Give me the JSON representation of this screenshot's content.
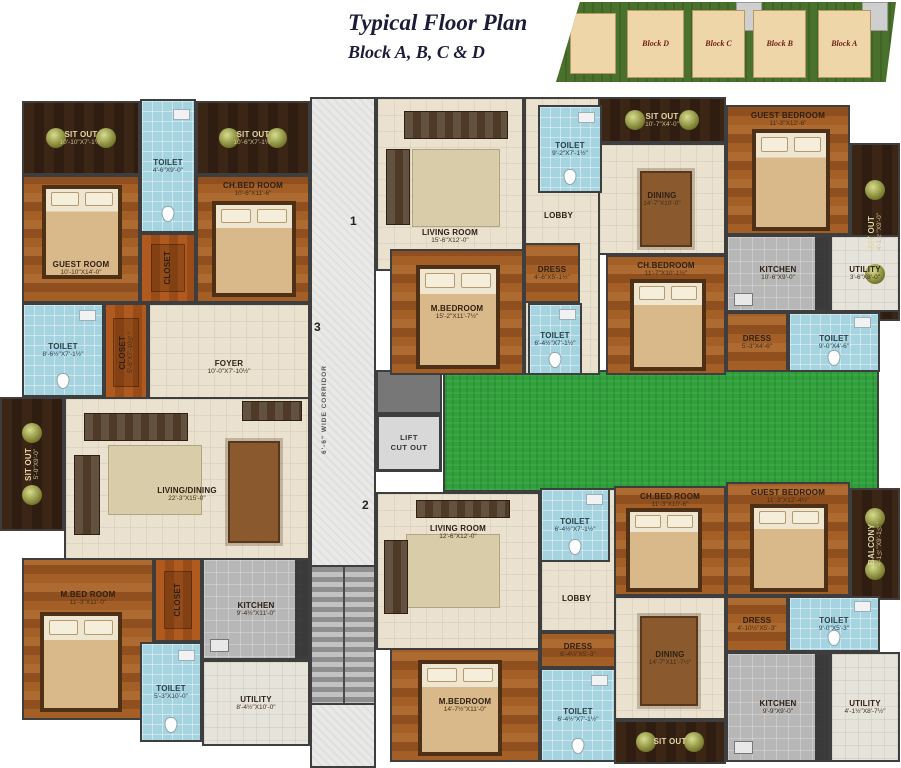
{
  "header": {
    "title": "Typical Floor Plan",
    "subtitle": "Block A, B, C & D"
  },
  "site_plan": {
    "block_d": "Block D",
    "block_c": "Block C",
    "block_b": "Block B",
    "block_a": "Block A"
  },
  "corridor": {
    "width_label": "6'-6\" WIDE CORRIDOR",
    "lift_line1": "LIFT",
    "lift_line2": "CUT OUT",
    "flat1": "1",
    "flat2": "2",
    "flat3": "3"
  },
  "rooms": {
    "sitout_tl": {
      "name": "SIT OUT",
      "dims": "10'-10\"X7'-1½\""
    },
    "toilet_tl": {
      "name": "TOILET",
      "dims": "4'-6\"X9'-0\""
    },
    "sitout_tc": {
      "name": "SIT OUT",
      "dims": "10'-6\"X7'-1½\""
    },
    "guest_room": {
      "name": "GUEST ROOM",
      "dims": "10'-10\"X14'-0\""
    },
    "closet_mid": {
      "name": "CLOSET",
      "dims": "4'-6\"X5'-0\""
    },
    "ch_bedroom_l": {
      "name": "CH.BED ROOM",
      "dims": "10'-6\"X11'-6\""
    },
    "toilet_l2": {
      "name": "TOILET",
      "dims": "8'-6½\"X7'-1½\""
    },
    "closet_l2": {
      "name": "CLOSET",
      "dims": "5'-6\"X7'-10½\""
    },
    "foyer": {
      "name": "FOYER",
      "dims": "10'-0\"X7'-10½\""
    },
    "sitout_lm": {
      "name": "SIT OUT",
      "dims": "5'-0\"X9'-0\""
    },
    "living_dining": {
      "name": "LIVING/DINING",
      "dims": "22'-3\"X15'-0\""
    },
    "mbedroom_l": {
      "name": "M.BED ROOM",
      "dims": "11'-3\"X11'-0\""
    },
    "closet_l3": {
      "name": "CLOSET",
      "dims": "4'-6\"X7'-0\""
    },
    "kitchen_l": {
      "name": "KITCHEN",
      "dims": "9'-4½\"X11'-0\""
    },
    "toilet_l3": {
      "name": "TOILET",
      "dims": "5'-3\"X10'-0\""
    },
    "utility_l": {
      "name": "UTILITY",
      "dims": "8'-4½\"X10'-0\""
    },
    "living_room_1": {
      "name": "LIVING ROOM",
      "dims": "15'-6\"X12'-0\""
    },
    "toilet_1a": {
      "name": "TOILET",
      "dims": "9'-2\"X7'-1½\""
    },
    "lobby_1": {
      "name": "LOBBY"
    },
    "dress_1": {
      "name": "DRESS",
      "dims": "4'-6\"X5'-1½\""
    },
    "mbedroom_1": {
      "name": "M.BEDROOM",
      "dims": "15'-2\"X11'-7½\""
    },
    "toilet_1b": {
      "name": "TOILET",
      "dims": "6'-4½\"X7'-1½\""
    },
    "sitout_tr_top": {
      "name": "SIT OUT",
      "dims": "10'-7\"X4'-0\""
    },
    "dining_tr": {
      "name": "DINING",
      "dims": "14'-7\"X10'-0\""
    },
    "ch_bedroom_tr": {
      "name": "CH.BEDROOM",
      "dims": "11'-7\"X10'-1½\""
    },
    "guest_bedroom_tr": {
      "name": "GUEST BEDROOM",
      "dims": "11'-3\"X12'-6\""
    },
    "sitout_tr_side": {
      "name": "SIT OUT",
      "dims": "4'-1½\"X9'-0\""
    },
    "kitchen_tr": {
      "name": "KITCHEN",
      "dims": "10'-6\"X9'-0\""
    },
    "utility_tr": {
      "name": "UTILITY",
      "dims": "3'-6\"X8'-0\""
    },
    "dress_tr": {
      "name": "DRESS",
      "dims": "5'-3\"X4'-6\""
    },
    "toilet_tr": {
      "name": "TOILET",
      "dims": "9'-0\"X4'-6\""
    },
    "living_room_2": {
      "name": "LIVING ROOM",
      "dims": "12'-6\"X12'-0\""
    },
    "toilet_2a": {
      "name": "TOILET",
      "dims": "6'-4½\"X7'-1½\""
    },
    "lobby_2": {
      "name": "LOBBY"
    },
    "dress_2": {
      "name": "DRESS",
      "dims": "6'-4½\"X5'-3\""
    },
    "mbedroom_2": {
      "name": "M.BEDROOM",
      "dims": "14'-7½\"X11'-0\""
    },
    "toilet_2b": {
      "name": "TOILET",
      "dims": "6'-4½\"X7'-1½\""
    },
    "ch_bedroom_br": {
      "name": "CH.BED ROOM",
      "dims": "11'-3\"X10'-6\""
    },
    "guest_bedroom_br": {
      "name": "GUEST BEDROOM",
      "dims": "11'-3\"X12'-4½\""
    },
    "balcony_br": {
      "name": "BALCONY",
      "dims": "4'-1½\"X9'-1½\""
    },
    "dress_br": {
      "name": "DRESS",
      "dims": "4'-10½\"X5'-3\""
    },
    "toilet_br": {
      "name": "TOILET",
      "dims": "9'-0\"X5'-3\""
    },
    "dining_br": {
      "name": "DINING",
      "dims": "14'-7\"X11'-7½\""
    },
    "sitout_br": {
      "name": "SIT OUT"
    },
    "kitchen_br": {
      "name": "KITCHEN",
      "dims": "9'-9\"X9'-0\""
    },
    "utility_br": {
      "name": "UTILITY",
      "dims": "4'-1½\"X8'-7½\""
    }
  }
}
